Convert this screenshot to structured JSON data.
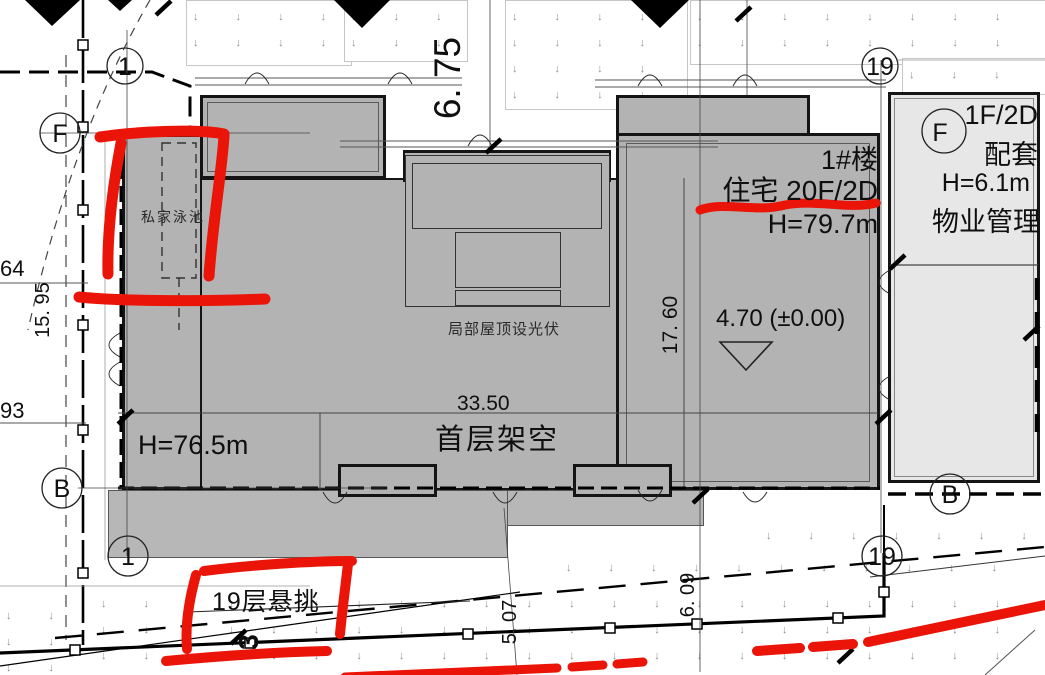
{
  "title": "住宅小区总平面图(局部)",
  "labels": {
    "building_no": "1#楼",
    "residence": "住宅 20F/2D",
    "residence_height": "H=79.7m",
    "left_tower_height": "H=76.5m",
    "stilt_dim": "33.50",
    "stilt_floor": "首层架空",
    "pv_note": "局部屋顶设光伏",
    "private_pool": "私家泳池",
    "elevation": "4.70 (±0.00)",
    "cantilever": "19层悬挑",
    "service_floors": "1F/2D",
    "service_type": "配套",
    "service_height": "H=6.1m",
    "service_mgmt": "物业管理"
  },
  "dimensions": {
    "top_setback": "6. 75",
    "tower_depth": "17. 60",
    "left_setback": "15. 95",
    "bottom_left_setback": "5. 07",
    "bottom_right_setback": "6. 09",
    "road_width": "3",
    "coord_upper": "64",
    "coord_lower": "93"
  },
  "axis_markers": {
    "col_1_top": "1",
    "col_19_top": "19",
    "col_1_bottom": "1",
    "col_19_bottom": "19",
    "row_f_left": "F",
    "row_f_right": "F",
    "row_b_left": "B",
    "row_b_right": "B"
  },
  "colors": {
    "building_fill": "#b3b3b3",
    "service_fill": "#e7e7e7",
    "marker_red": "#ea1408",
    "grass_symbol": "#8f8f8f",
    "line_black": "#141414"
  },
  "decor": {
    "grass_glyph": "↓"
  }
}
